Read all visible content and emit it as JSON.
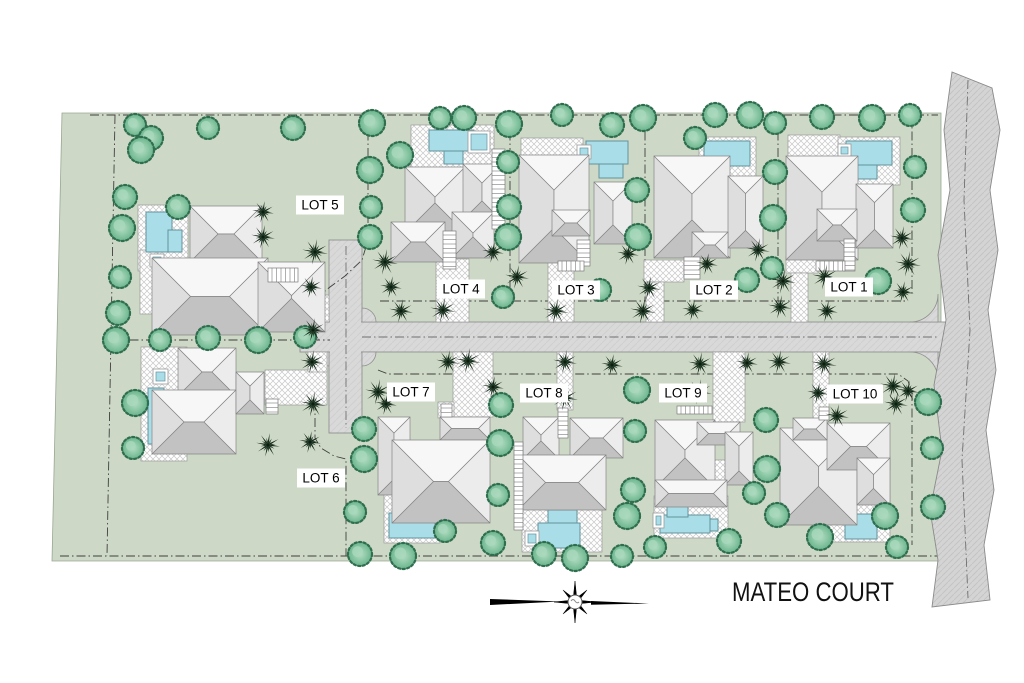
{
  "title": "MATEO COURT",
  "colors": {
    "land": "#cdd9c6",
    "land_edge": "#9aa694",
    "road": "#d9d9d9",
    "road_edge": "#8f8f8f",
    "band": "#d4d4d4",
    "boundary_line": "#3f3f3f",
    "pool": "#a9dee8",
    "pool_edge": "#64929c",
    "tree_fill": "#7cc29b",
    "tree_core": "#a9d8bd",
    "tree_edge": "#2f6e4e",
    "palm": "#16291a",
    "roof_n": "#f7f7f7",
    "roof_s": "#c2c2c2",
    "roof_w": "#dedede",
    "roof_e": "#ececec",
    "roof_edge": "#858585",
    "hatch_line": "#c7c7c7",
    "label_text": "#000000"
  },
  "lots": [
    {
      "label": "LOT 1",
      "cx": 849,
      "cy": 287,
      "w": 48
    },
    {
      "label": "LOT 2",
      "cx": 714,
      "cy": 290,
      "w": 48
    },
    {
      "label": "LOT 3",
      "cx": 576,
      "cy": 290,
      "w": 48
    },
    {
      "label": "LOT 4",
      "cx": 461,
      "cy": 289,
      "w": 48
    },
    {
      "label": "LOT 5",
      "cx": 320,
      "cy": 205,
      "w": 48
    },
    {
      "label": "LOT 6",
      "cx": 321,
      "cy": 478,
      "w": 48
    },
    {
      "label": "LOT 7",
      "cx": 411,
      "cy": 392,
      "w": 48
    },
    {
      "label": "LOT 8",
      "cx": 544,
      "cy": 393,
      "w": 48
    },
    {
      "label": "LOT 9",
      "cx": 683,
      "cy": 393,
      "w": 48
    },
    {
      "label": "LOT 10",
      "cx": 855,
      "cy": 394,
      "w": 56
    }
  ],
  "land": [
    [
      62,
      113
    ],
    [
      941,
      113
    ],
    [
      941,
      561
    ],
    [
      52,
      561
    ]
  ],
  "roads": {
    "stub_rect": [
      329,
      240,
      33,
      193
    ],
    "main_rect": [
      300,
      322,
      652,
      30
    ],
    "fillets": [
      "M 362,308 A 14 14 0 0 1 376,322 L 362,322 Z",
      "M 376,352 A 14 14 0 0 1 362,366 L 362,352 Z",
      "M 329,308 A 14 14 0 0 0 315,322 L 329,322 Z",
      "M 315,352 A 14 14 0 0 0 329,366 L 329,352 Z",
      "M 910,322 A 28 28 0 0 0 938,294 L 938,322 Z",
      "M 938,380 A 28 28 0 0 0 910,352 L 938,352 Z"
    ],
    "centerlines": [
      [
        [
          362,
          337
        ],
        [
          938,
          337
        ]
      ],
      [
        [
          346,
          246
        ],
        [
          346,
          428
        ]
      ]
    ]
  },
  "band": {
    "outline": [
      [
        952,
        72
      ],
      [
        944,
        130
      ],
      [
        950,
        190
      ],
      [
        938,
        255
      ],
      [
        946,
        320
      ],
      [
        934,
        385
      ],
      [
        942,
        450
      ],
      [
        930,
        510
      ],
      [
        938,
        560
      ],
      [
        932,
        607
      ],
      [
        990,
        600
      ],
      [
        984,
        545
      ],
      [
        994,
        490
      ],
      [
        986,
        430
      ],
      [
        996,
        370
      ],
      [
        988,
        310
      ],
      [
        998,
        250
      ],
      [
        990,
        190
      ],
      [
        1000,
        130
      ],
      [
        992,
        88
      ]
    ],
    "dashline": [
      [
        968,
        80
      ],
      [
        964,
        200
      ],
      [
        970,
        330
      ],
      [
        962,
        460
      ],
      [
        968,
        598
      ]
    ]
  },
  "boundaries": [
    [
      [
        90,
        115
      ],
      [
        938,
        115
      ]
    ],
    [
      [
        115,
        115
      ],
      [
        107,
        556
      ]
    ],
    [
      [
        60,
        556
      ],
      [
        938,
        556
      ]
    ],
    [
      [
        113,
        340
      ],
      [
        330,
        340
      ]
    ],
    [
      [
        368,
        115
      ],
      [
        368,
        240
      ],
      [
        362,
        260
      ],
      [
        345,
        276
      ],
      [
        326,
        290
      ],
      [
        316,
        303
      ],
      [
        315,
        338
      ]
    ],
    [
      [
        315,
        352
      ],
      [
        315,
        438
      ],
      [
        321,
        448
      ],
      [
        334,
        456
      ],
      [
        346,
        459
      ],
      [
        346,
        556
      ]
    ],
    [
      [
        510,
        115
      ],
      [
        510,
        301
      ]
    ],
    [
      [
        645,
        115
      ],
      [
        645,
        301
      ]
    ],
    [
      [
        778,
        115
      ],
      [
        778,
        301
      ]
    ],
    [
      [
        912,
        115
      ],
      [
        912,
        295
      ]
    ],
    [
      [
        380,
        301
      ],
      [
        908,
        301
      ]
    ],
    [
      [
        378,
        370
      ],
      [
        388,
        374
      ],
      [
        898,
        374
      ],
      [
        908,
        381
      ],
      [
        912,
        392
      ]
    ],
    [
      [
        912,
        392
      ],
      [
        912,
        545
      ]
    ]
  ],
  "driveways": [
    [
      270,
      295,
      59,
      27
    ],
    [
      436,
      259,
      33,
      63
    ],
    [
      548,
      262,
      26,
      60
    ],
    [
      644,
      260,
      40,
      22
    ],
    [
      646,
      282,
      18,
      40
    ],
    [
      786,
      257,
      32,
      16
    ],
    [
      791,
      273,
      17,
      49
    ],
    [
      265,
      370,
      62,
      35
    ],
    [
      308,
      352,
      19,
      20
    ],
    [
      453,
      352,
      40,
      65
    ],
    [
      438,
      402,
      16,
      16
    ],
    [
      557,
      352,
      16,
      58
    ],
    [
      713,
      352,
      32,
      70
    ],
    [
      813,
      352,
      16,
      68
    ]
  ],
  "decks": [
    [
      138,
      205,
      50,
      66
    ],
    [
      140,
      250,
      18,
      64
    ],
    [
      411,
      125,
      83,
      49
    ],
    [
      521,
      138,
      62,
      36
    ],
    [
      699,
      137,
      57,
      57
    ],
    [
      788,
      135,
      52,
      27
    ],
    [
      838,
      137,
      62,
      48
    ],
    [
      141,
      347,
      46,
      114
    ],
    [
      384,
      483,
      56,
      60
    ],
    [
      413,
      465,
      23,
      21
    ],
    [
      522,
      507,
      80,
      45
    ],
    [
      545,
      468,
      18,
      16
    ],
    [
      654,
      496,
      74,
      42
    ],
    [
      697,
      460,
      30,
      28
    ],
    [
      828,
      456,
      62,
      86
    ],
    [
      830,
      478,
      24,
      22
    ]
  ],
  "houses": [
    {
      "lot": 5,
      "blocks": [
        [
          190,
          206,
          72,
          56
        ],
        [
          152,
          258,
          116,
          77
        ],
        [
          258,
          262,
          67,
          70
        ]
      ],
      "steps": [
        [
          268,
          268,
          30,
          14,
          "h"
        ]
      ]
    },
    {
      "lot": 4,
      "blocks": [
        [
          405,
          167,
          60,
          66
        ],
        [
          463,
          164,
          38,
          56
        ],
        [
          391,
          222,
          54,
          40
        ],
        [
          452,
          212,
          42,
          46
        ]
      ],
      "steps": [
        [
          492,
          149,
          13,
          80,
          "v"
        ],
        [
          443,
          231,
          13,
          38,
          "v"
        ]
      ]
    },
    {
      "lot": 3,
      "blocks": [
        [
          519,
          155,
          70,
          108
        ],
        [
          594,
          182,
          38,
          62
        ],
        [
          552,
          210,
          38,
          26
        ]
      ],
      "steps": [
        [
          577,
          240,
          13,
          26,
          "v"
        ],
        [
          558,
          261,
          26,
          10,
          "h"
        ]
      ]
    },
    {
      "lot": 2,
      "blocks": [
        [
          654,
          156,
          76,
          102
        ],
        [
          728,
          176,
          35,
          72
        ],
        [
          692,
          232,
          36,
          26
        ]
      ],
      "steps": [
        [
          684,
          257,
          16,
          22,
          "v"
        ]
      ]
    },
    {
      "lot": 1,
      "blocks": [
        [
          786,
          156,
          72,
          104
        ],
        [
          856,
          184,
          37,
          64
        ],
        [
          817,
          209,
          40,
          32
        ]
      ],
      "steps": [
        [
          844,
          239,
          11,
          32,
          "v"
        ],
        [
          816,
          261,
          29,
          10,
          "h"
        ]
      ]
    },
    {
      "lot": 6,
      "blocks": [
        [
          178,
          348,
          58,
          48
        ],
        [
          152,
          390,
          84,
          64
        ],
        [
          236,
          372,
          28,
          42
        ]
      ],
      "steps": [
        [
          266,
          399,
          12,
          15,
          "v"
        ]
      ]
    },
    {
      "lot": 7,
      "blocks": [
        [
          378,
          417,
          32,
          78
        ],
        [
          440,
          417,
          50,
          23
        ],
        [
          392,
          440,
          98,
          83
        ]
      ],
      "steps": [
        [
          441,
          404,
          11,
          13,
          "v"
        ]
      ]
    },
    {
      "lot": 8,
      "blocks": [
        [
          523,
          417,
          36,
          42
        ],
        [
          570,
          418,
          53,
          40
        ],
        [
          518,
          455,
          88,
          55
        ]
      ],
      "steps": [
        [
          514,
          442,
          9,
          88,
          "v"
        ],
        [
          558,
          408,
          10,
          30,
          "v"
        ]
      ]
    },
    {
      "lot": 9,
      "blocks": [
        [
          655,
          420,
          60,
          68
        ],
        [
          697,
          422,
          43,
          23
        ],
        [
          725,
          432,
          28,
          53
        ],
        [
          655,
          480,
          72,
          27
        ]
      ],
      "steps": [
        [
          677,
          406,
          35,
          8,
          "h"
        ]
      ]
    },
    {
      "lot": 10,
      "blocks": [
        [
          780,
          428,
          77,
          97
        ],
        [
          827,
          423,
          63,
          47
        ],
        [
          857,
          458,
          33,
          47
        ],
        [
          793,
          418,
          34,
          22
        ]
      ],
      "steps": [
        [
          819,
          407,
          10,
          13,
          "v"
        ]
      ]
    }
  ],
  "pools": [
    {
      "lot": 5,
      "rects": [
        [
          146,
          212,
          26,
          40
        ],
        [
          168,
          230,
          14,
          22
        ]
      ],
      "spa": [
        150,
        254,
        14,
        13
      ]
    },
    {
      "lot": 4,
      "rects": [
        [
          429,
          130,
          45,
          21
        ],
        [
          444,
          151,
          19,
          13
        ]
      ],
      "spa": [
        468,
        131,
        22,
        22
      ]
    },
    {
      "lot": 3,
      "rects": [
        [
          586,
          141,
          42,
          23
        ],
        [
          599,
          164,
          24,
          14
        ]
      ],
      "spa": [
        577,
        145,
        14,
        14
      ]
    },
    {
      "lot": 2,
      "rects": [
        [
          704,
          141,
          46,
          25
        ],
        [
          707,
          166,
          21,
          22
        ]
      ],
      "spa": null
    },
    {
      "lot": 1,
      "rects": [
        [
          846,
          141,
          46,
          24
        ],
        [
          857,
          165,
          20,
          14
        ]
      ],
      "spa": [
        838,
        144,
        13,
        13
      ]
    },
    {
      "lot": 6,
      "rects": [
        [
          148,
          388,
          16,
          56
        ],
        [
          164,
          424,
          10,
          12
        ]
      ],
      "spa": [
        153,
        369,
        15,
        15
      ]
    },
    {
      "lot": 7,
      "rects": [
        [
          412,
          488,
          23,
          34
        ],
        [
          389,
          513,
          46,
          25
        ]
      ],
      "spa": null
    },
    {
      "lot": 8,
      "rects": [
        [
          548,
          510,
          29,
          14
        ],
        [
          538,
          523,
          42,
          25
        ]
      ],
      "spa": [
        525,
        531,
        14,
        15
      ]
    },
    {
      "lot": 9,
      "rects": [
        [
          660,
          515,
          50,
          18
        ],
        [
          667,
          505,
          21,
          12
        ],
        [
          710,
          519,
          8,
          12
        ]
      ],
      "spa": [
        653,
        513,
        11,
        15
      ]
    },
    {
      "lot": 10,
      "rects": [
        [
          833,
          464,
          20,
          52
        ],
        [
          845,
          514,
          32,
          25
        ]
      ],
      "spa": null
    }
  ],
  "trees_round": [
    [
      135,
      125
    ],
    [
      151,
      138
    ],
    [
      141,
      150
    ],
    [
      208,
      128
    ],
    [
      293,
      128
    ],
    [
      372,
      123
    ],
    [
      440,
      118
    ],
    [
      464,
      118
    ],
    [
      509,
      124
    ],
    [
      562,
      115
    ],
    [
      612,
      125
    ],
    [
      643,
      118
    ],
    [
      695,
      138
    ],
    [
      715,
      115
    ],
    [
      750,
      115
    ],
    [
      775,
      123
    ],
    [
      822,
      117
    ],
    [
      872,
      118
    ],
    [
      910,
      115
    ],
    [
      125,
      197
    ],
    [
      122,
      228
    ],
    [
      120,
      277
    ],
    [
      118,
      313
    ],
    [
      116,
      340
    ],
    [
      160,
      340
    ],
    [
      208,
      338
    ],
    [
      258,
      340
    ],
    [
      305,
      337
    ],
    [
      178,
      207
    ],
    [
      370,
      170
    ],
    [
      371,
      207
    ],
    [
      370,
      237
    ],
    [
      400,
      155
    ],
    [
      508,
      162
    ],
    [
      509,
      207
    ],
    [
      508,
      237
    ],
    [
      503,
      297
    ],
    [
      637,
      190
    ],
    [
      638,
      237
    ],
    [
      600,
      290
    ],
    [
      775,
      172
    ],
    [
      773,
      218
    ],
    [
      772,
      268
    ],
    [
      747,
      280
    ],
    [
      878,
      281
    ],
    [
      915,
      167
    ],
    [
      913,
      210
    ],
    [
      135,
      403
    ],
    [
      133,
      448
    ],
    [
      364,
      429
    ],
    [
      364,
      459
    ],
    [
      355,
      512
    ],
    [
      501,
      405
    ],
    [
      500,
      443
    ],
    [
      498,
      495
    ],
    [
      493,
      543
    ],
    [
      637,
      390
    ],
    [
      635,
      431
    ],
    [
      633,
      490
    ],
    [
      627,
      516
    ],
    [
      655,
      547
    ],
    [
      766,
      420
    ],
    [
      767,
      469
    ],
    [
      754,
      493
    ],
    [
      777,
      515
    ],
    [
      928,
      402
    ],
    [
      932,
      448
    ],
    [
      933,
      507
    ],
    [
      885,
      516
    ],
    [
      897,
      547
    ],
    [
      360,
      554
    ],
    [
      403,
      556
    ],
    [
      445,
      531
    ],
    [
      544,
      554
    ],
    [
      575,
      558
    ],
    [
      622,
      556
    ],
    [
      729,
      541
    ],
    [
      820,
      537
    ]
  ],
  "trees_palm": [
    [
      263,
      212
    ],
    [
      263,
      237
    ],
    [
      315,
      252
    ],
    [
      311,
      287
    ],
    [
      313,
      330
    ],
    [
      385,
      262
    ],
    [
      391,
      287
    ],
    [
      401,
      311
    ],
    [
      443,
      310
    ],
    [
      493,
      252
    ],
    [
      517,
      277
    ],
    [
      556,
      311
    ],
    [
      628,
      254
    ],
    [
      649,
      288
    ],
    [
      643,
      311
    ],
    [
      707,
      264
    ],
    [
      758,
      250
    ],
    [
      783,
      281
    ],
    [
      693,
      310
    ],
    [
      780,
      307
    ],
    [
      825,
      277
    ],
    [
      827,
      311
    ],
    [
      902,
      238
    ],
    [
      908,
      264
    ],
    [
      903,
      292
    ],
    [
      312,
      362
    ],
    [
      313,
      404
    ],
    [
      310,
      442
    ],
    [
      268,
      445
    ],
    [
      378,
      392
    ],
    [
      386,
      404
    ],
    [
      448,
      362
    ],
    [
      468,
      361
    ],
    [
      493,
      387
    ],
    [
      565,
      362
    ],
    [
      565,
      398
    ],
    [
      612,
      365
    ],
    [
      700,
      364
    ],
    [
      699,
      392
    ],
    [
      747,
      363
    ],
    [
      779,
      362
    ],
    [
      824,
      364
    ],
    [
      818,
      393
    ],
    [
      837,
      416
    ],
    [
      893,
      386
    ],
    [
      908,
      391
    ],
    [
      896,
      404
    ]
  ],
  "compass": {
    "cx": 575,
    "cy": 602,
    "r_long": 21,
    "r_short": 17,
    "r_inner": 4.5,
    "left_wing": [
      [
        490,
        599
      ],
      [
        560,
        601.5
      ],
      [
        490,
        605
      ]
    ],
    "right_wing": [
      [
        591,
        601
      ],
      [
        649,
        603.5
      ],
      [
        591,
        604.8
      ]
    ]
  },
  "title_pos": {
    "x": 813,
    "y": 601,
    "size": 27,
    "length": 162
  }
}
